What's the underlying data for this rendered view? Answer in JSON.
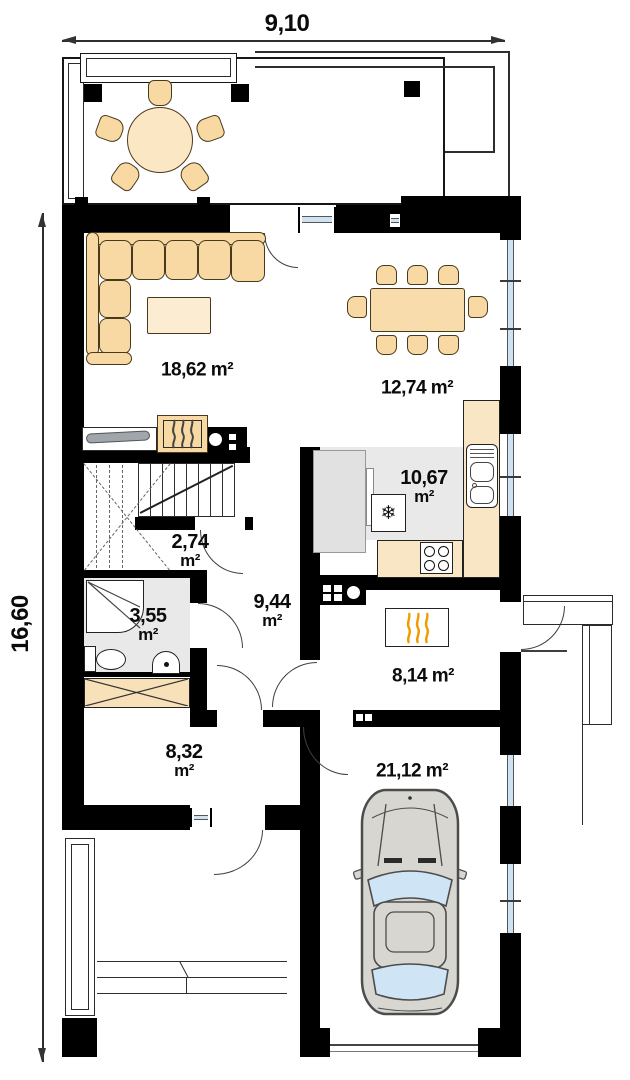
{
  "plan_dimensions": {
    "width_label": "9,10",
    "height_label": "16,60"
  },
  "rooms": {
    "living": {
      "label": "18,62 m²"
    },
    "dining": {
      "label": "12,74 m²"
    },
    "kitchen": {
      "value": "10,67",
      "unit": "m²"
    },
    "stairs": {
      "value": "2,74",
      "unit": "m²"
    },
    "bathroom": {
      "value": "3,55",
      "unit": "m²"
    },
    "hall": {
      "value": "9,44",
      "unit": "m²"
    },
    "boiler": {
      "label": "8,14 m²"
    },
    "vestibule": {
      "value": "8,32",
      "unit": "m²"
    },
    "garage": {
      "label": "21,12 m²"
    }
  },
  "icons": {
    "fridge": "❄"
  },
  "colors": {
    "wall": "#000000",
    "furniture_tan": "#f8d9a3",
    "furniture_light": "#fbecd2",
    "counter_tan": "#f9e6c4",
    "floor_gray": "#e9e9e9",
    "glass_blue": "#cfe2f2",
    "flame_orange": "#ef9c00",
    "flame_dark": "#444444",
    "car_gray": "#d7d6d1"
  }
}
